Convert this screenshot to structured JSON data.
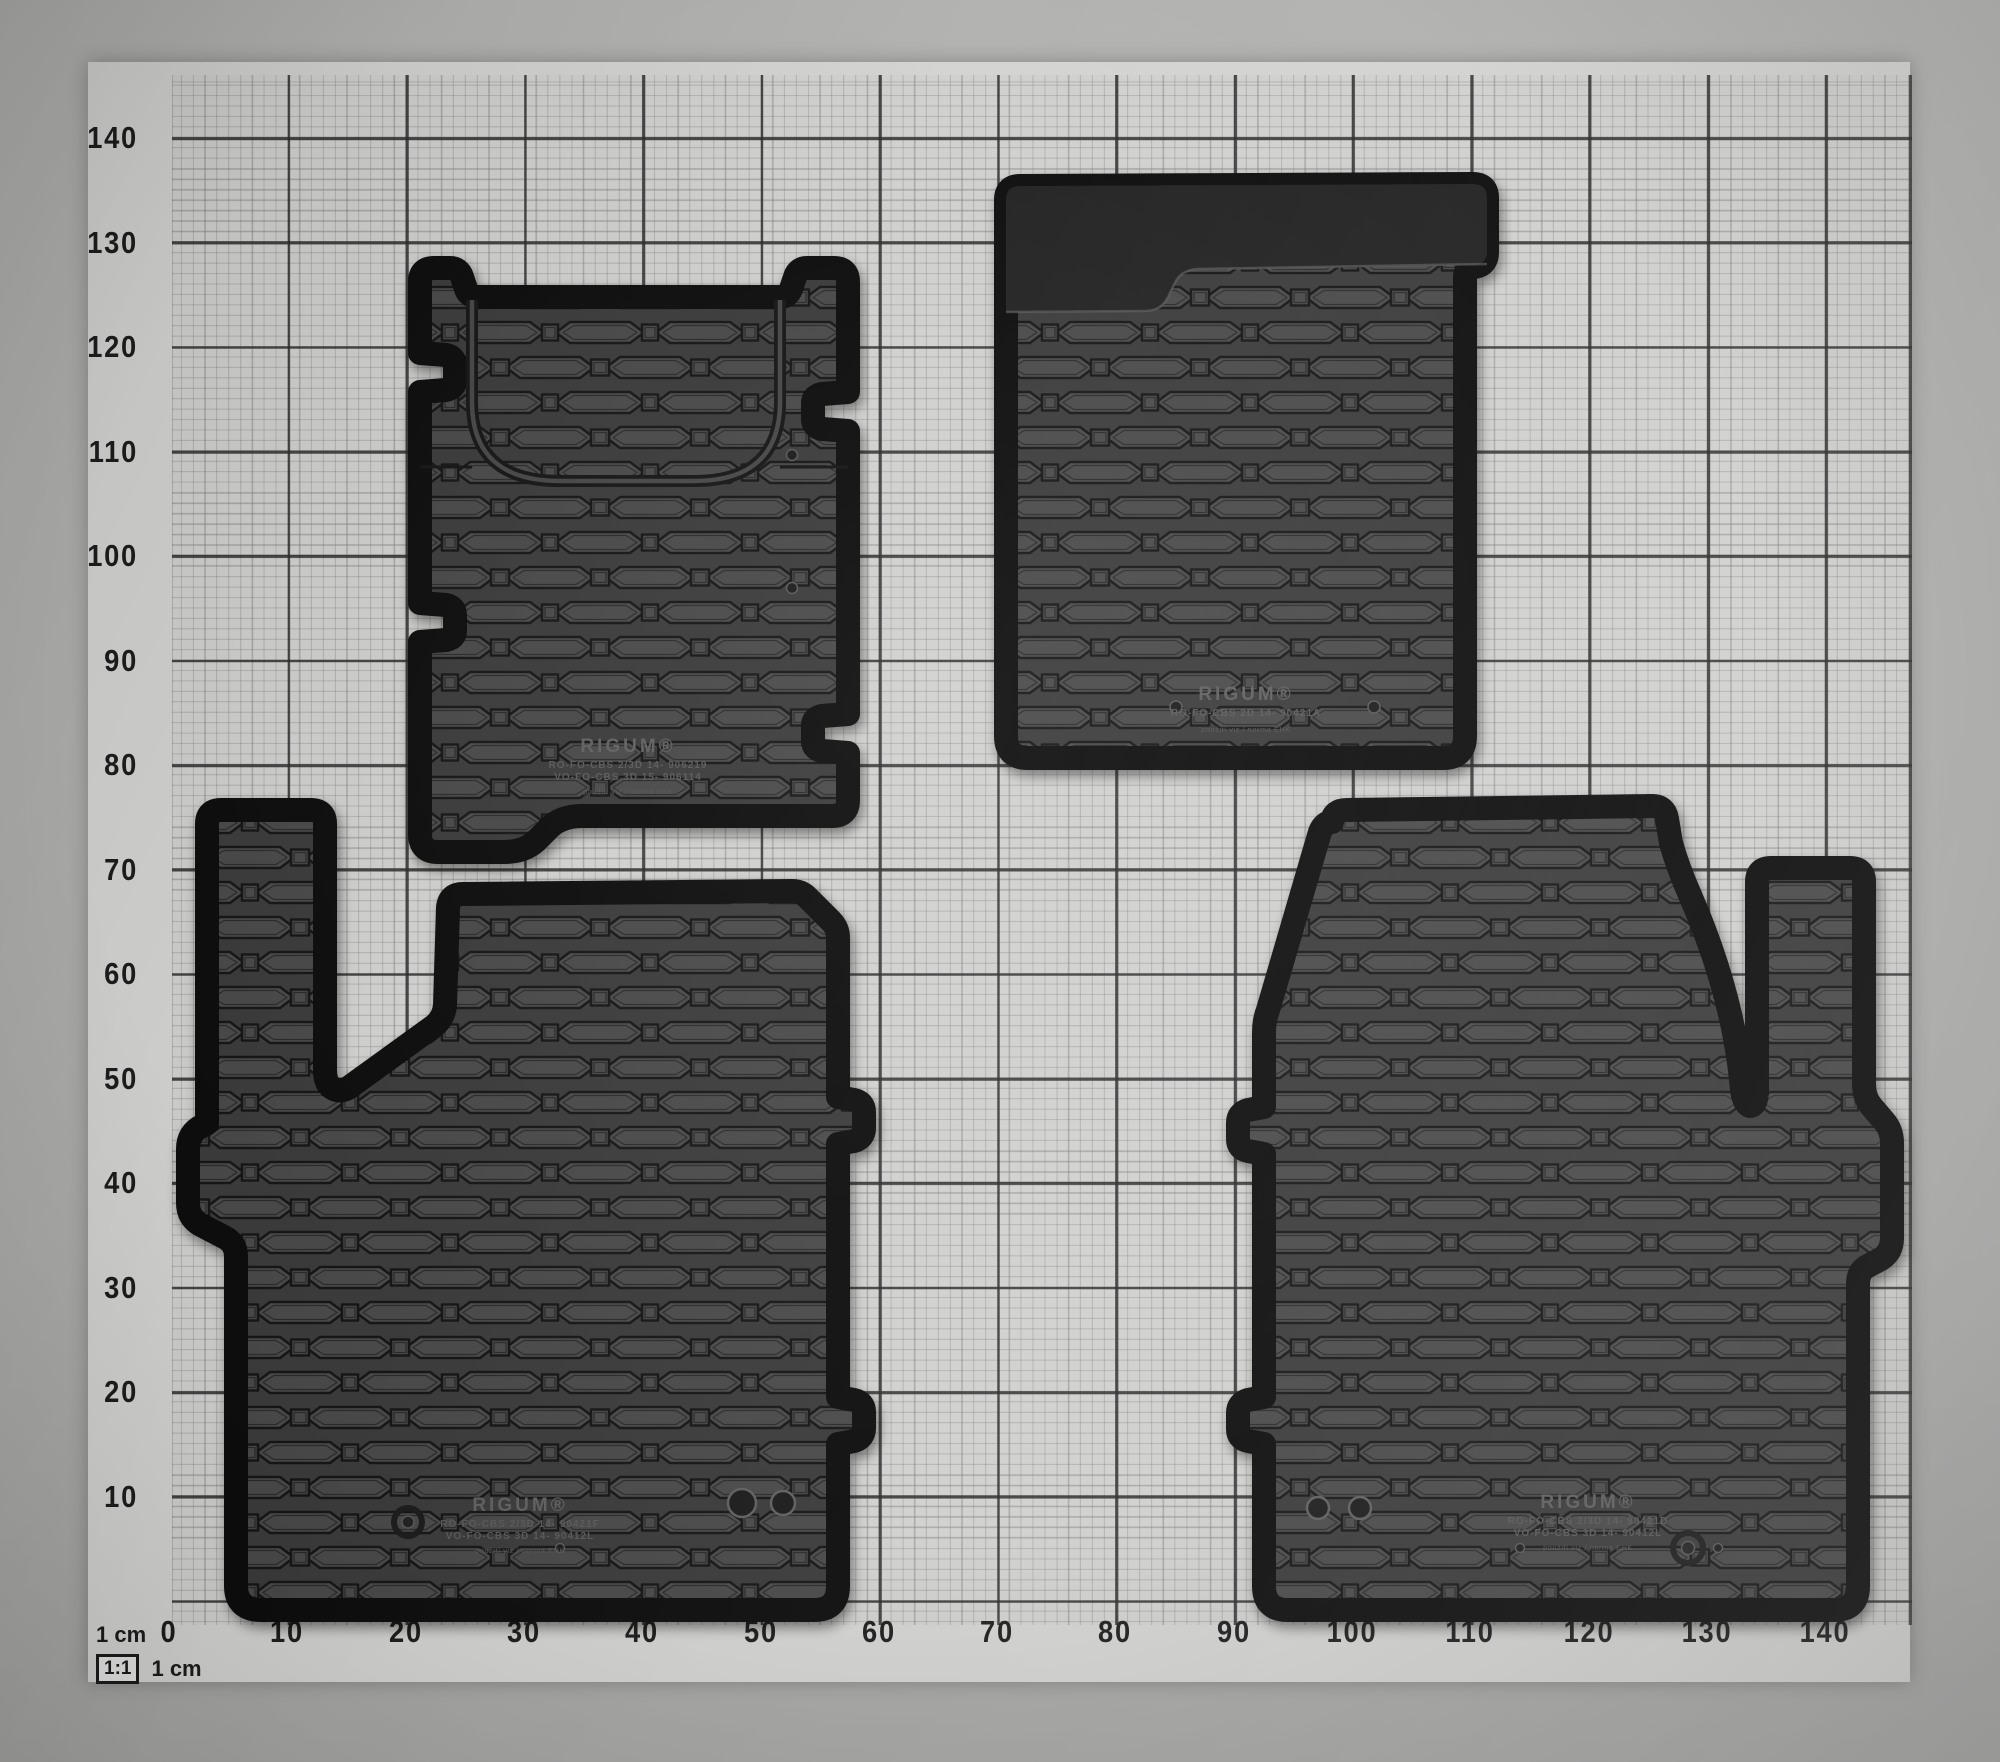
{
  "meta": {
    "description": "Four black RIGUM rubber car floor mats photographed on 1:1 centimetre grid paper"
  },
  "scale_legend": {
    "top": "1 cm",
    "ratio": "1:1",
    "bottom": "1 cm"
  },
  "axes": {
    "y_ticks": [
      "140",
      "130",
      "120",
      "110",
      "100",
      "90",
      "80",
      "70",
      "60",
      "50",
      "40",
      "30",
      "20",
      "10"
    ],
    "x_ticks": [
      "0",
      "10",
      "20",
      "30",
      "40",
      "50",
      "60",
      "70",
      "80",
      "90",
      "100",
      "110",
      "120",
      "130",
      "140"
    ]
  },
  "mats": {
    "rear_left": {
      "brand": "RIGUM®",
      "code_line1": "RO-FO-CBS 2/3D 14- 906219",
      "code_line2": "VO-FO-CBS 3D 15- 906114",
      "note": "použití viz / norma EHK"
    },
    "rear_right": {
      "brand": "RIGUM®",
      "code_line1": "RO-FO-CBS 2D 14- 90421A",
      "note": "použití viz / norma EHK"
    },
    "front_driver": {
      "brand": "RIGUM®",
      "code_line1": "RO-FO-CBS 2/3D 14- 90421F",
      "code_line2": "VO-FO-CBS 3D 14- 90412L",
      "note": "použití viz / norma EHK"
    },
    "front_passenger": {
      "brand": "RIGUM®",
      "code_line1": "RO-FO-CBS 2/3D 14- 90421D",
      "code_line2": "VO-FO-CBS 3D 14- 90412L",
      "note": "použití viz / norma EHK"
    }
  },
  "colors": {
    "paper": "#d3d3d1",
    "background_border": "#aeaeac",
    "grid_fine": "#b6b6b4",
    "grid_major": "#2e2e2e",
    "mat_edge": "#0b0b0b",
    "mat_surface": "#4a4a4a",
    "mat_smooth_band": "#232323",
    "axis_label": "#1d1d1d"
  }
}
